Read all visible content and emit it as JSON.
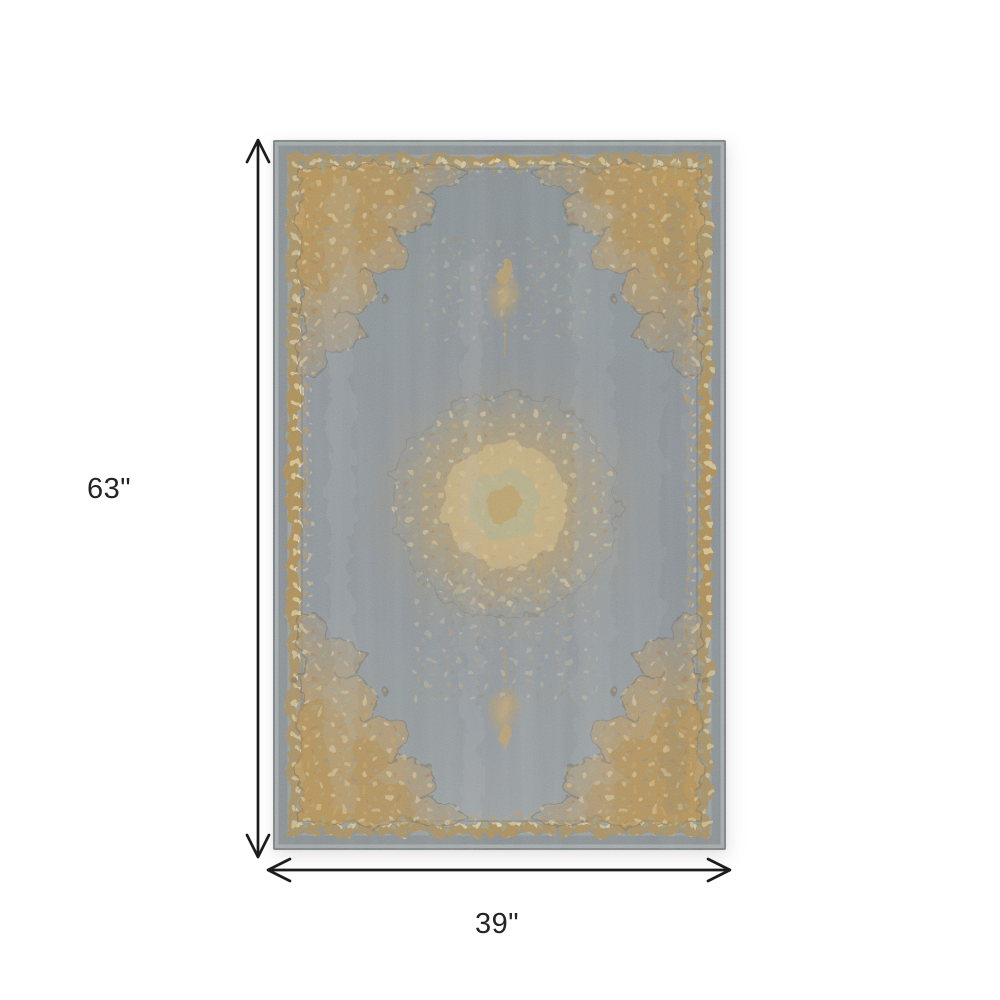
{
  "diagram": {
    "height_label": "63\"",
    "width_label": "39\""
  },
  "product": {
    "type": "area rug photo",
    "style": "distressed traditional medallion rug with ornate corner motifs and gold border",
    "palette": {
      "field_gray": "#8E959A",
      "edge_gray": "#868D91",
      "border_gold": "#C2A05E",
      "accent_cream": "#E3D2A6",
      "accent_sage": "#9FA98F",
      "accent_rust": "#A87E4C"
    }
  },
  "annotation": {
    "arrow_color": "#1C1C1C",
    "text_color": "#242424",
    "canvas_background": "#FFFFFF"
  }
}
